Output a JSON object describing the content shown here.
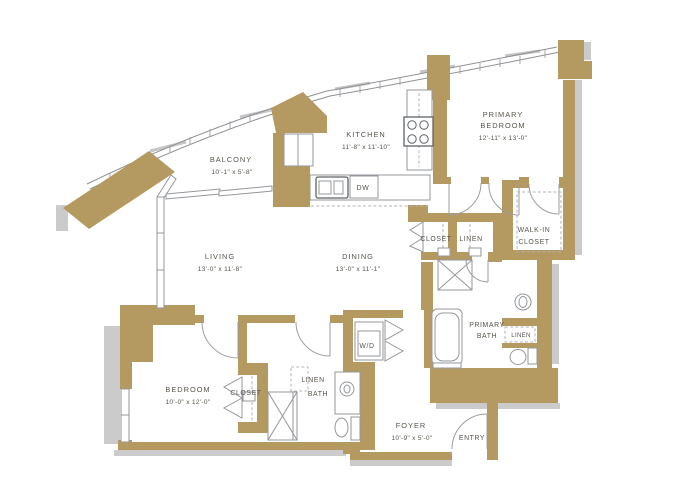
{
  "rooms": {
    "balcony": {
      "label": "BALCONY",
      "dims": "10'-1\" x 5'-8\""
    },
    "kitchen": {
      "label": "KITCHEN",
      "dims": "11'-8\" x 11'-10\""
    },
    "primary_bedroom": {
      "line1": "PRIMARY",
      "line2": "BEDROOM",
      "dims": "12'-11\" x 13'-0\""
    },
    "living": {
      "label": "LIVING",
      "dims": "13'-0\" x 11'-8\""
    },
    "dining": {
      "label": "DINING",
      "dims": "13'-0\" x 11'-1\""
    },
    "hall_closet": {
      "label": "CLOSET"
    },
    "hall_linen": {
      "label": "LINEN"
    },
    "walk_in_closet": {
      "line1": "WALK-IN",
      "line2": "CLOSET"
    },
    "primary_bath": {
      "line1": "PRIMARY",
      "line2": "BATH"
    },
    "primary_bath_linen": {
      "label": "LINEN"
    },
    "bedroom": {
      "label": "BEDROOM",
      "dims": "10'-0\" x 12'-0\""
    },
    "bedroom_closet": {
      "label": "CLOSET"
    },
    "bath_linen": {
      "label": "LINEN"
    },
    "bath": {
      "label": "BATH"
    },
    "laundry": {
      "label": "W/D"
    },
    "foyer": {
      "label": "FOYER",
      "dims": "10'-9\" x 5'-0\""
    },
    "entry": {
      "label": "ENTRY"
    },
    "appliances": {
      "dishwasher": "DW"
    }
  },
  "colors": {
    "wall": "#b49a60",
    "shadow": "#cbcbcb",
    "fixture_line": "#93979b",
    "text": "#59544c",
    "background": "#ffffff"
  }
}
